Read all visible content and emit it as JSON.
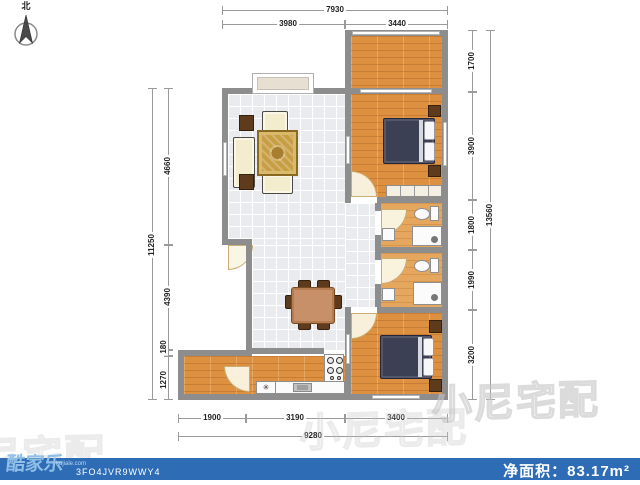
{
  "compass": {
    "label": "北"
  },
  "dims": {
    "top": {
      "total": "7930",
      "segments": [
        "3980",
        "3440"
      ]
    },
    "left": {
      "total": "11250",
      "segments": [
        "4660",
        "4390",
        "180",
        "1270"
      ]
    },
    "right": {
      "total": "13560",
      "segments": [
        "1700",
        "3900",
        "1800",
        "1990",
        "3200"
      ]
    },
    "bottom": {
      "total": "9280",
      "segments": [
        "1900",
        "3190",
        "3400"
      ]
    }
  },
  "kitchen": {
    "symbol": "✳"
  },
  "watermark": {
    "text": "小尼宅配"
  },
  "footer": {
    "logo": "酷家乐",
    "logo_domain": "kujiale.com",
    "code": "3FO4JVR9WWY4",
    "area_label": "净面积：",
    "area_value": "83.17m²"
  },
  "colors": {
    "wall": "#8d8d8d",
    "wood_floor": "#dd9040",
    "tile_floor": "#e9ebee",
    "bed": "#3c4054",
    "footer_bg": "#2e6cb5",
    "logo_accent": "#8fbfe8"
  }
}
